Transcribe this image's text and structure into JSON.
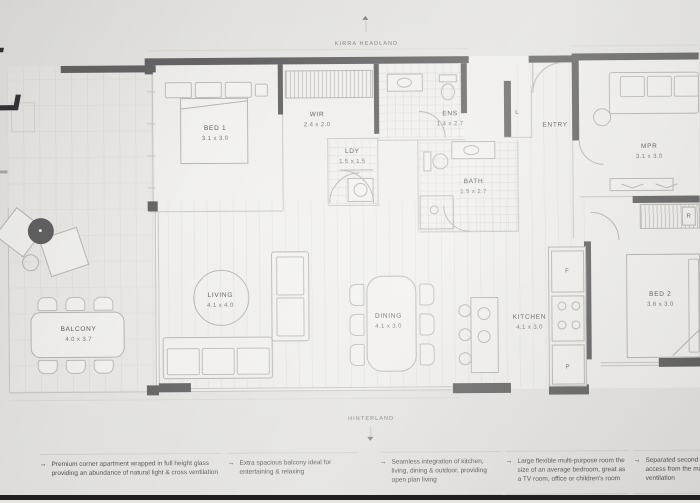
{
  "page": {
    "logo_glyph": "L",
    "compass_top": "KIRRA HEADLAND",
    "compass_bottom": "HINTERLAND",
    "arrow_char": "→"
  },
  "rooms": [
    {
      "name": "BED 1",
      "dims": "3.1 x 3.0"
    },
    {
      "name": "WIR",
      "dims": "2.4 x 2.0"
    },
    {
      "name": "ENS",
      "dims": "1.4 x 2.7"
    },
    {
      "name": "LDY",
      "dims": "1.5 x 1.5"
    },
    {
      "name": "BATH",
      "dims": "1.5 x 2.7"
    },
    {
      "name": "ENTRY",
      "dims": ""
    },
    {
      "name": "MPR",
      "dims": "3.1 x 3.0"
    },
    {
      "name": "LIVING",
      "dims": "4.1 x 4.0"
    },
    {
      "name": "DINING",
      "dims": "4.1 x 3.0"
    },
    {
      "name": "KITCHEN",
      "dims": "4.1 x 3.0"
    },
    {
      "name": "BED 2",
      "dims": "3.6 x 3.0"
    },
    {
      "name": "BALCONY",
      "dims": "4.0 x 3.7"
    }
  ],
  "fixtures": {
    "linen": "L",
    "fridge": "F",
    "pantry": "P",
    "robe": "R"
  },
  "annotations": [
    {
      "text": "Premium corner apartment wrapped in full height glass providing an abundance of natural light & cross ventilation"
    },
    {
      "text": "Extra spacious balcony ideal for entertaining & relaxing"
    },
    {
      "text": "Seamless integration of kitchen, living, dining & outdoor, providing open plan living"
    },
    {
      "text": "Large flexible multi-purpose room the size of an average bedroom, great as a TV room, office or children's room"
    },
    {
      "text": "Separated second bedroom with access from the main living, views & ventilation"
    }
  ],
  "colors": {
    "wall": "#5a5a5a",
    "paper": "#e6e5e2",
    "line": "#b4b2ae",
    "text": "#4a4a4a",
    "photo_edge": "#1f1f1f"
  }
}
